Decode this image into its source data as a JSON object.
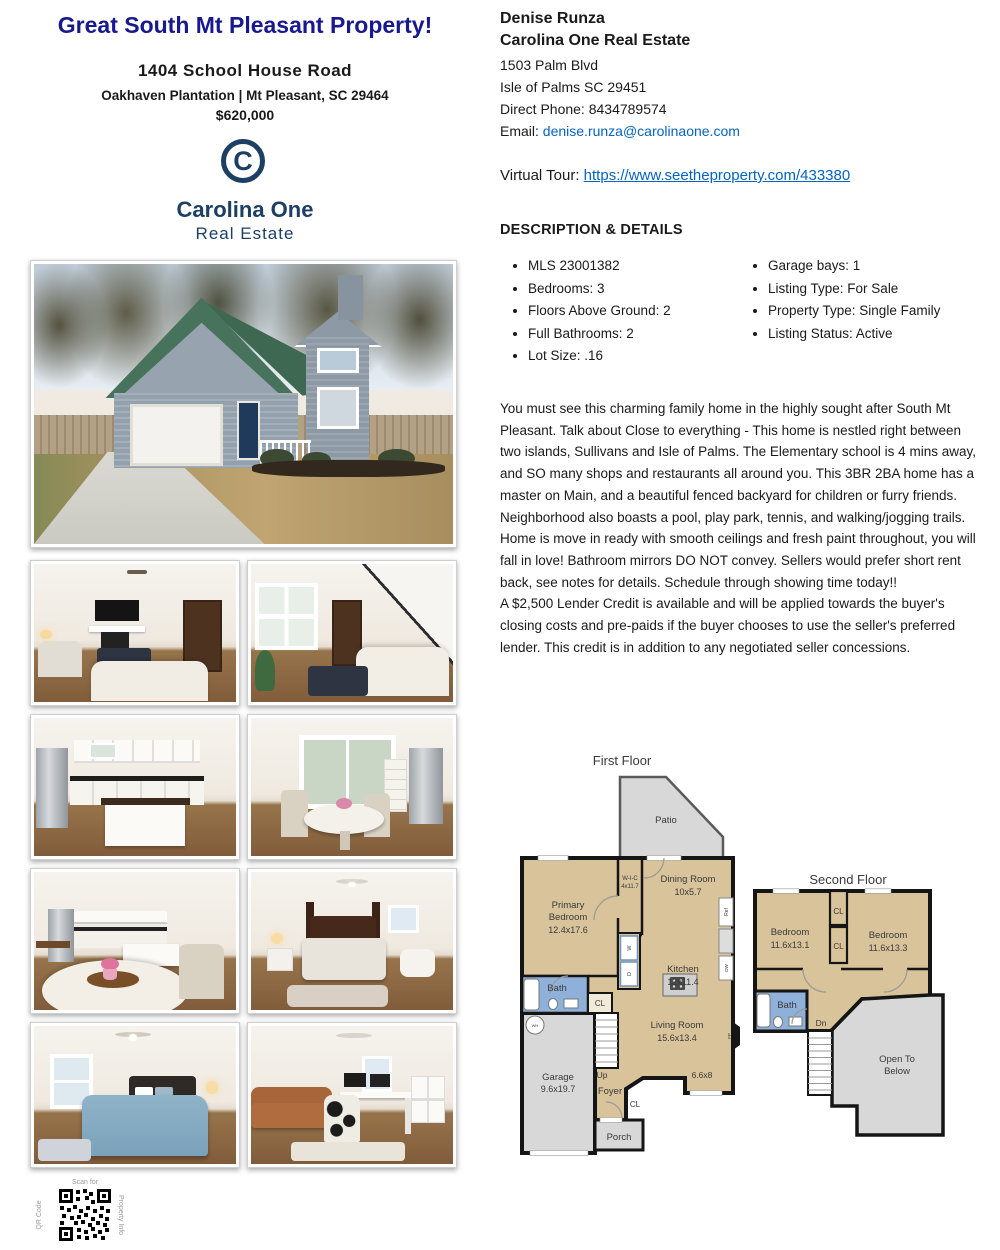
{
  "flyer": {
    "title": "Great South Mt Pleasant Property!",
    "addr1": "1404 School House Road",
    "addr2": "Oakhaven Plantation | Mt Pleasant, SC 29464",
    "price": "$620,000"
  },
  "logo": {
    "mark": "C",
    "brand": "Carolina One",
    "sub": "Real Estate"
  },
  "agent": {
    "name": "Denise Runza",
    "company": "Carolina One Real Estate",
    "street": "1503 Palm Blvd",
    "city": "Isle of Palms SC 29451",
    "phone": "Direct Phone: 8434789574",
    "email_label": "Email: ",
    "email": "denise.runza@carolinaone.com"
  },
  "tour": {
    "label": "Virtual Tour: ",
    "url": "https://www.seetheproperty.com/433380"
  },
  "details": {
    "heading": "DESCRIPTION & DETAILS",
    "left": [
      "MLS 23001382",
      "Bedrooms: 3",
      "Floors Above Ground: 2",
      "Full Bathrooms: 2",
      "Lot Size: .16"
    ],
    "right": [
      "Garage bays: 1",
      "Listing Type: For Sale",
      "Property Type: Single Family",
      "Listing Status: Active"
    ]
  },
  "description": {
    "para1": "You must see this charming family home in the highly sought after South Mt Pleasant. Talk about Close to everything - This home is nestled right between two islands, Sullivans and Isle of Palms. The Elementary school is 4 mins away, and SO many shops and restaurants all around you. This 3BR 2BA home has a master on Main, and a beautiful fenced backyard for children or furry friends. Neighborhood also boasts a pool, play park, tennis, and walking/jogging trails. Home is move in ready with smooth ceilings and fresh paint throughout, you will fall in love! Bathroom mirrors DO NOT convey. Sellers would prefer short rent back, see notes for details. Schedule through showing time today!!",
    "para2": "A $2,500 Lender Credit is available and will be applied towards the buyer's closing costs and pre-paids if the buyer chooses to use the seller's preferred lender. This credit is in addition to any negotiated seller concessions."
  },
  "floor1": {
    "title": "First Floor",
    "patio": "Patio",
    "primary1": "Primary",
    "primary2": "Bedroom",
    "primary_dims": "12.4x17.6",
    "wic": "W-I-C",
    "wic_dims": "4x11.7",
    "dining": "Dining Room",
    "dining_dims": "10x5.7",
    "kitchen": "Kitchen",
    "kitchen_dims": "12x11.4",
    "ref": "Ref",
    "dw": "DW",
    "w": "W",
    "d": "D",
    "bath": "Bath",
    "cl": "CL",
    "cl2": "CL",
    "living": "Living Room",
    "living_dims": "15.6x13.4",
    "nook_dims": "6.6x8",
    "garage": "Garage",
    "garage_dims": "9.6x19.7",
    "wh": "WH",
    "up": "Up",
    "foyer": "Foyer",
    "porch": "Porch",
    "fp": "FP"
  },
  "floor2": {
    "title": "Second Floor",
    "bed1": "Bedroom",
    "bed1_dims": "11.6x13.1",
    "bed2": "Bedroom",
    "bed2_dims": "11.6x13.3",
    "cl1": "CL",
    "cl2": "CL",
    "bath": "Bath",
    "dn": "Dn",
    "open1": "Open To",
    "open2": "Below"
  },
  "qr": {
    "top": "Scan for",
    "side_left": "QR Code",
    "side_right": "Property Info"
  },
  "photos": {
    "main": "front exterior - gray house with green metal roof",
    "grid": [
      "living room with fireplace",
      "living room with staircase",
      "kitchen with island",
      "breakfast nook with sliding doors",
      "kitchen and dining view",
      "primary bedroom",
      "bedroom with blue bedding",
      "home office"
    ]
  },
  "colors": {
    "title_navy": "#18188f",
    "logo_navy": "#1d3f63",
    "link_blue": "#0563c1",
    "plan_tan": "#d8c39a",
    "plan_bath_blue": "#8fb0d8",
    "plan_gray": "#d8d8d8"
  }
}
